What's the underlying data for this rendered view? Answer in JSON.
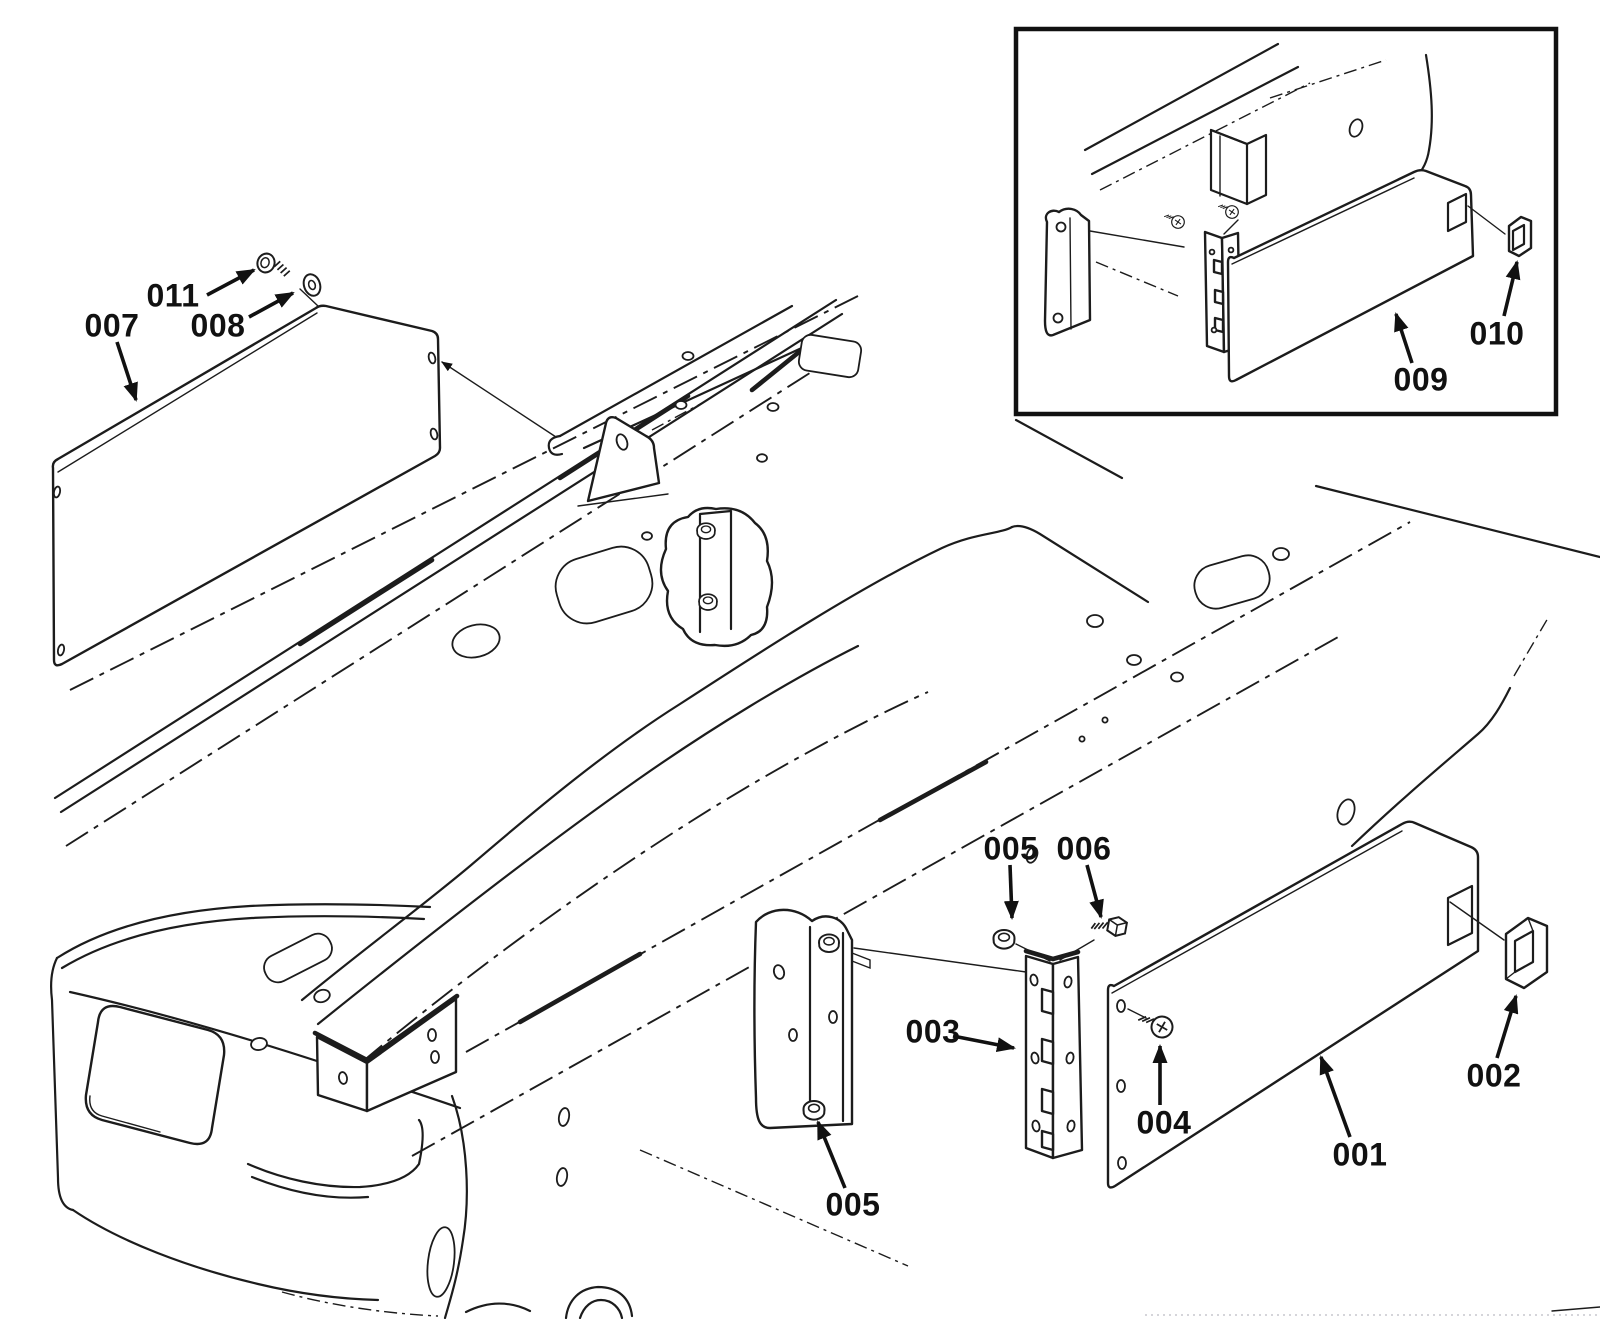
{
  "diagram": {
    "type": "exploded-parts-diagram",
    "background_color": "#ffffff",
    "line_color": "#1c1c1c",
    "callouts": [
      {
        "part": "007",
        "label": "007",
        "x": 112,
        "y": 326,
        "arrow": {
          "x1": 117,
          "y1": 342,
          "x2": 136,
          "y2": 400
        }
      },
      {
        "part": "011",
        "label": "011",
        "x": 173,
        "y": 296,
        "arrow": {
          "x1": 207,
          "y1": 295,
          "x2": 254,
          "y2": 270
        }
      },
      {
        "part": "008",
        "label": "008",
        "x": 218,
        "y": 326,
        "arrow": {
          "x1": 249,
          "y1": 317,
          "x2": 293,
          "y2": 293
        }
      },
      {
        "part": "005",
        "label": "005",
        "x": 1011,
        "y": 849,
        "arrow": {
          "x1": 1010,
          "y1": 865,
          "x2": 1012,
          "y2": 918
        }
      },
      {
        "part": "006",
        "label": "006",
        "x": 1084,
        "y": 849,
        "arrow": {
          "x1": 1087,
          "y1": 865,
          "x2": 1101,
          "y2": 917
        }
      },
      {
        "part": "003",
        "label": "003",
        "x": 933,
        "y": 1032,
        "arrow": {
          "x1": 953,
          "y1": 1036,
          "x2": 1014,
          "y2": 1048
        }
      },
      {
        "part": "005",
        "label": "005",
        "x": 853,
        "y": 1205,
        "arrow": {
          "x1": 845,
          "y1": 1188,
          "x2": 818,
          "y2": 1122
        }
      },
      {
        "part": "004",
        "label": "004",
        "x": 1164,
        "y": 1123,
        "arrow": {
          "x1": 1160,
          "y1": 1105,
          "x2": 1160,
          "y2": 1046
        }
      },
      {
        "part": "001",
        "label": "001",
        "x": 1360,
        "y": 1155,
        "arrow": {
          "x1": 1350,
          "y1": 1137,
          "x2": 1321,
          "y2": 1057
        }
      },
      {
        "part": "002",
        "label": "002",
        "x": 1494,
        "y": 1076,
        "arrow": {
          "x1": 1497,
          "y1": 1058,
          "x2": 1516,
          "y2": 996
        }
      },
      {
        "part": "009",
        "label": "009",
        "x": 1421,
        "y": 380,
        "arrow": {
          "x1": 1412,
          "y1": 363,
          "x2": 1396,
          "y2": 314
        }
      },
      {
        "part": "010",
        "label": "010",
        "x": 1497,
        "y": 334,
        "arrow": {
          "x1": 1504,
          "y1": 316,
          "x2": 1517,
          "y2": 262
        }
      }
    ]
  }
}
